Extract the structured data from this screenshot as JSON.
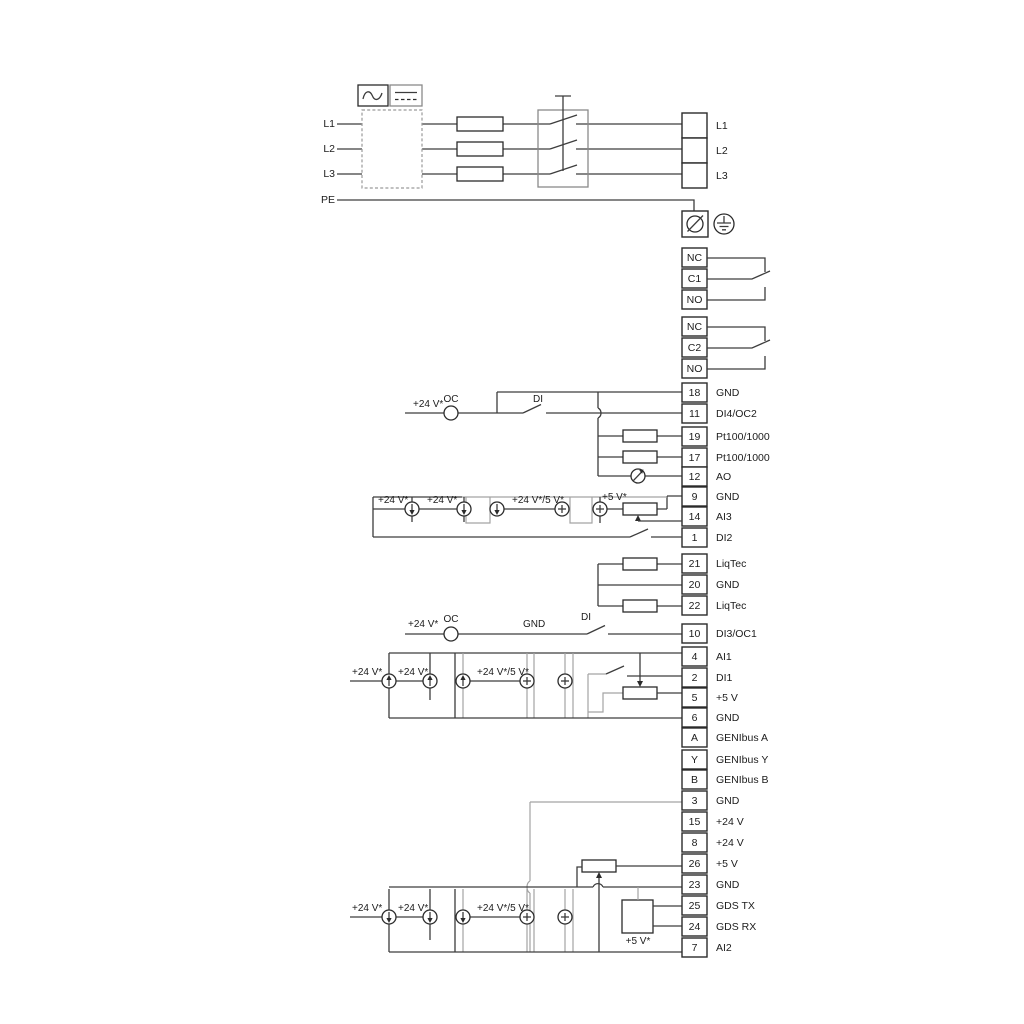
{
  "power": {
    "inputs": [
      "L1",
      "L2",
      "L3",
      "PE"
    ],
    "outputs": [
      "L1",
      "L2",
      "L3"
    ]
  },
  "relays": [
    [
      "NC",
      "C1",
      "NO"
    ],
    [
      "NC",
      "C2",
      "NO"
    ]
  ],
  "labels": {
    "v24": "+24 V*",
    "v24v5": "+24 V*/5 V*",
    "v5": "+5 V*",
    "oc": "OC",
    "di": "DI",
    "gnd": "GND"
  },
  "io_block_a": [
    {
      "n": "18",
      "l": "GND"
    },
    {
      "n": "11",
      "l": "DI4/OC2"
    },
    {
      "n": "19",
      "l": "Pt100/1000"
    },
    {
      "n": "17",
      "l": "Pt100/1000"
    },
    {
      "n": "12",
      "l": "AO"
    },
    {
      "n": "9",
      "l": "GND"
    },
    {
      "n": "14",
      "l": "AI3"
    },
    {
      "n": "1",
      "l": "DI2"
    }
  ],
  "io_block_b": [
    {
      "n": "21",
      "l": "LiqTec"
    },
    {
      "n": "20",
      "l": "GND"
    },
    {
      "n": "22",
      "l": "LiqTec"
    }
  ],
  "io_block_c": [
    {
      "n": "10",
      "l": "DI3/OC1"
    }
  ],
  "io_block_d": [
    {
      "n": "4",
      "l": "AI1"
    },
    {
      "n": "2",
      "l": "DI1"
    },
    {
      "n": "5",
      "l": "+5 V"
    },
    {
      "n": "6",
      "l": "GND"
    },
    {
      "n": "A",
      "l": "GENIbus A"
    },
    {
      "n": "Y",
      "l": "GENIbus Y"
    },
    {
      "n": "B",
      "l": "GENIbus B"
    }
  ],
  "io_block_e": [
    {
      "n": "3",
      "l": "GND"
    },
    {
      "n": "15",
      "l": "+24 V"
    },
    {
      "n": "8",
      "l": "+24 V"
    },
    {
      "n": "26",
      "l": "+5 V"
    },
    {
      "n": "23",
      "l": "GND"
    },
    {
      "n": "25",
      "l": "GDS TX"
    },
    {
      "n": "24",
      "l": "GDS RX"
    },
    {
      "n": "7",
      "l": "AI2"
    }
  ]
}
